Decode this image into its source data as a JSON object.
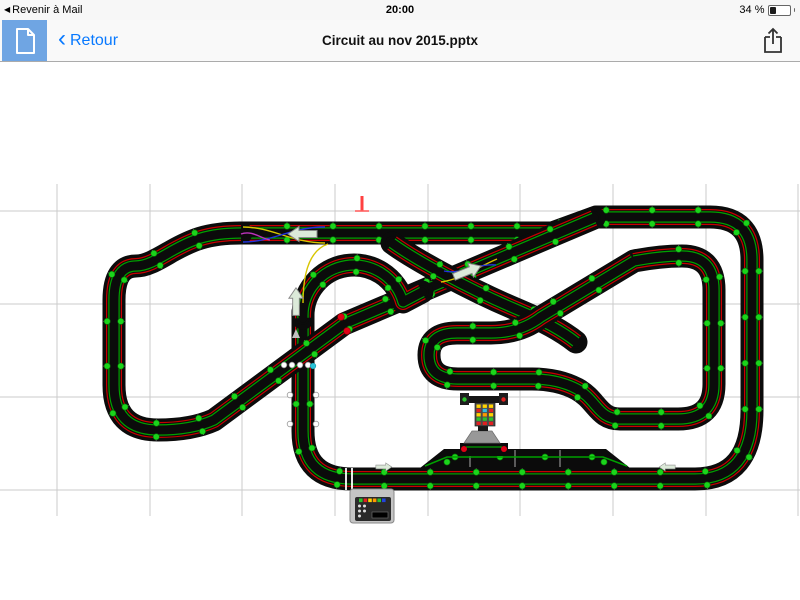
{
  "status_bar": {
    "left_text": "Revenir à Mail",
    "time": "20:00",
    "battery_text": "34 %",
    "battery_percent": 34
  },
  "toolbar": {
    "back_label": "Retour",
    "title": "Circuit au nov 2015.pptx"
  },
  "track": {
    "colors": {
      "track": "#0b0b0b",
      "red_lane": "#c80000",
      "green_lane": "#00a000",
      "dot": "#1bd41b",
      "dot_edge": "#067006",
      "tick": "#a8a8a8",
      "white_dot": "#ffffff",
      "cyan_dot": "#2ac3d8",
      "red_dot": "#e00016",
      "arrow_fill": "#dcead9",
      "arrow_edge": "#8a8a8a"
    },
    "grid": {
      "xs": [
        57,
        150,
        242,
        335,
        428,
        520,
        613,
        706,
        798
      ],
      "ys": [
        211,
        304,
        397,
        490
      ],
      "x_range": [
        0,
        800
      ],
      "y_range": [
        184,
        516
      ],
      "color": "#cbcbcb"
    },
    "strands": [
      {
        "name": "outer-circuit",
        "step": 46,
        "d": "M 241,233 L 552,233 L 596,217 L 710,217 Q 752,217 752,260 L 752,410 Q 752,479 695,479 L 352,479 Q 303,479 303,431 L 303,312"
      },
      {
        "name": "left-loop-diagonal",
        "step": 46,
        "d": "M 241,233 C 206,233 190,241 172,251 C 158,259 147,266 136,266 Q 114,266 114,300 L 114,385 Q 114,430 158,430 Q 192,430 214,420 L 344,324 L 594,218"
      },
      {
        "name": "crossover-diagonal",
        "step": 52,
        "d": "M 392,243 C 414,259 468,289 518,310 Q 556,326 576,342"
      },
      {
        "name": "inner-kidney-loop",
        "step": 44,
        "d": "M 634,261 Q 660,256 682,256 Q 714,256 714,290 L 714,384 Q 714,419 678,419 L 620,419 C 598,419 597,400 577,389 Q 558,379 532,379 L 458,379 Q 429,379 429,355 Q 429,333 457,333 L 491,333 Q 520,333 541,317 L 634,261"
      },
      {
        "name": "teardrop-loop",
        "step": 40,
        "d": "M 303,318 A 51 51 0 0 1 403,302 L 422,292"
      }
    ],
    "pit": {
      "polygon": "420,468 444,449 606,449 630,468",
      "lane": "M 425,466 L 447,457 L 603,457 L 627,466",
      "ticks": [
        470,
        515,
        560
      ],
      "dots": [
        [
          455,
          457
        ],
        [
          500,
          457
        ],
        [
          545,
          457
        ],
        [
          592,
          457
        ],
        [
          447,
          462
        ],
        [
          604,
          462
        ]
      ]
    },
    "chicanes": [
      {
        "d": "M 243,227 C 272,227 292,243 325,243",
        "c": "#d8c500"
      },
      {
        "d": "M 243,242 C 272,242 292,227 325,227",
        "c": "#2233dd"
      },
      {
        "d": "M 241,234 C 252,230 260,238 270,240",
        "c": "#bb33bb"
      },
      {
        "d": "M 328,244 C 310,250 303,272 303,303",
        "c": "#d8c500"
      },
      {
        "d": "M 441,282 C 462,279 478,267 497,259",
        "c": "#d8c500"
      },
      {
        "d": "M 444,271 C 461,275 478,263 496,265",
        "c": "#2233dd"
      }
    ],
    "arrows": [
      {
        "name": "lane-change-arrow-left",
        "x": 304,
        "y": 234,
        "rot": 180,
        "s": 1
      },
      {
        "name": "lane-change-arrow-right",
        "x": 466,
        "y": 272,
        "rot": -22,
        "s": 1
      },
      {
        "name": "direction-arrow-up",
        "x": 296,
        "y": 303,
        "rot": -90,
        "s": 0.95
      },
      {
        "name": "direction-arrow-right-small",
        "x": 383,
        "y": 467,
        "rot": 0,
        "s": 0.55
      },
      {
        "name": "direction-arrow-left-small",
        "x": 668,
        "y": 467,
        "rot": 180,
        "s": 0.55
      }
    ],
    "markers": {
      "red_tick": {
        "x": 362,
        "y1": 196,
        "y2": 211
      },
      "red_dots": [
        [
          341,
          317
        ],
        [
          347,
          331
        ]
      ],
      "white_dots": [
        [
          284,
          365
        ],
        [
          292,
          365
        ],
        [
          300,
          365
        ],
        [
          308,
          365
        ],
        [
          290,
          395
        ],
        [
          316,
          395
        ],
        [
          290,
          424
        ],
        [
          316,
          424
        ]
      ],
      "cyan_dot": [
        313,
        366
      ],
      "triangle": [
        296,
        334
      ]
    },
    "start_line": {
      "xs": [
        346,
        352
      ],
      "y1": 468,
      "y2": 490
    },
    "light_tower": {
      "bar": [
        463,
        396,
        42,
        7
      ],
      "lamp_left_color": "#2bc22b",
      "lamp_right_color": "#e02020",
      "column": [
        475,
        403,
        20,
        23
      ],
      "lights": [
        [
          "#ffd400",
          "#ffd400",
          "#ffd400"
        ],
        [
          "#e02020",
          "#33bbdd",
          "#e02020"
        ],
        [
          "#ffd400",
          "#ff9900",
          "#ffd400"
        ],
        [
          "#2bc22b",
          "#2bc22b",
          "#2bc22b"
        ],
        [
          "#e02020",
          "#e02020",
          "#e02020"
        ]
      ],
      "pedestal": "472,431 492,431 500,443 464,443",
      "base": [
        460,
        443,
        48,
        13
      ]
    },
    "power_base": {
      "box": [
        350,
        489,
        44,
        34
      ],
      "panel": [
        355,
        497,
        36,
        24
      ],
      "buttons": [
        "#2bc22b",
        "#e02020",
        "#ffd400",
        "#ff9900",
        "#2bc22b",
        "#2244dd"
      ],
      "screen": [
        372,
        512,
        16,
        6
      ]
    }
  }
}
